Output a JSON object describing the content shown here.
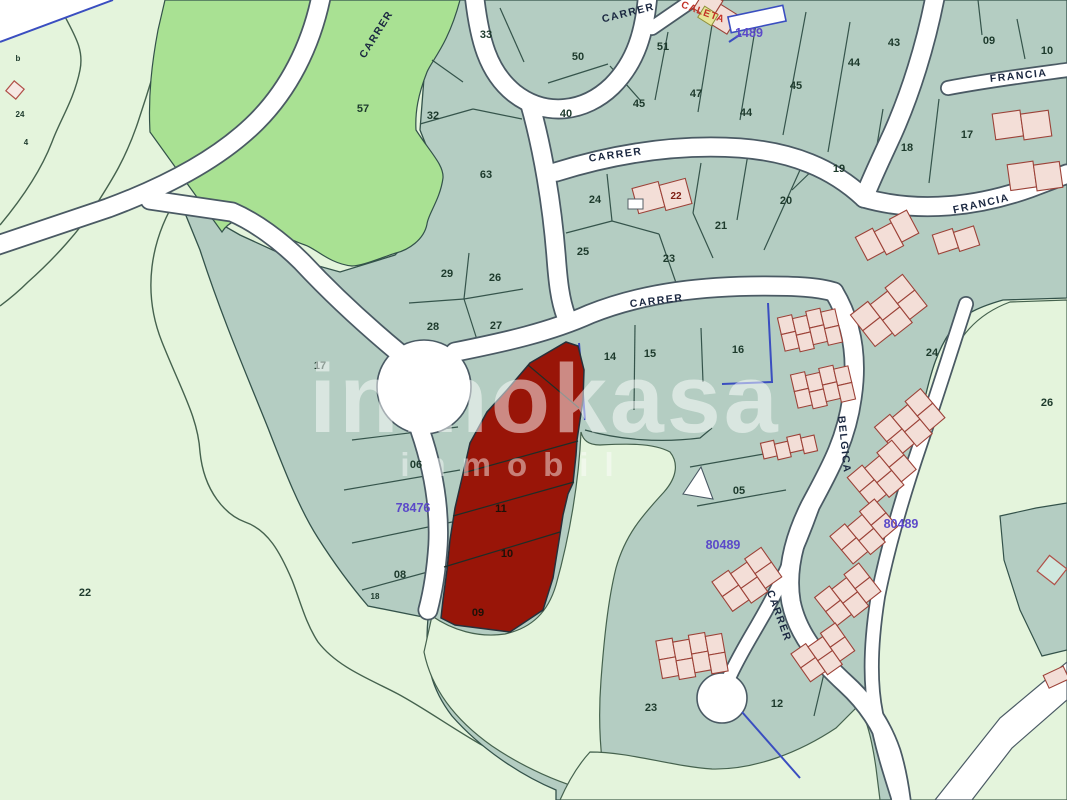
{
  "title": "Cadastral parcel map",
  "watermark": {
    "line1": "inmokasa",
    "line2": "inmobil"
  },
  "colors": {
    "pale": "#e4f4dc",
    "teal": "#b4cdc2",
    "bright": "#a9e193",
    "red_parcel": "#991508",
    "street": "#ffffff",
    "casing": "#4a5a64",
    "boundary": "#33524a",
    "purple": "#5b49c9",
    "street_text": "#1a2740",
    "parcel_text": "#1d3a2c",
    "building_fill": "#f3ded7",
    "building_stroke": "#9c4238",
    "caleta": "#c23227",
    "blue_line": "#3a4ec0"
  },
  "street_labels": [
    {
      "text": "CARRER",
      "x": 379,
      "y": 36,
      "rot": -58
    },
    {
      "text": "CARRER",
      "x": 629,
      "y": 16,
      "rot": -14
    },
    {
      "text": "CARRER",
      "x": 616,
      "y": 158,
      "rot": -8
    },
    {
      "text": "FRANCIA",
      "x": 1019,
      "y": 79,
      "rot": -6
    },
    {
      "text": "FRANCIA",
      "x": 982,
      "y": 207,
      "rot": -13
    },
    {
      "text": "CARRER",
      "x": 657,
      "y": 304,
      "rot": -7
    },
    {
      "text": "BELGICA",
      "x": 841,
      "y": 445,
      "rot": 84
    },
    {
      "text": "CARRER",
      "x": 776,
      "y": 617,
      "rot": 70
    }
  ],
  "special_labels": [
    {
      "text": "CALETA",
      "x": 702,
      "y": 15,
      "rot": 20
    }
  ],
  "building_labels": [
    {
      "text": "22",
      "x": 676,
      "y": 199
    }
  ],
  "ref_labels": [
    {
      "text": "1489",
      "x": 749,
      "y": 37
    },
    {
      "text": "78476",
      "x": 413,
      "y": 512
    },
    {
      "text": "80489",
      "x": 723,
      "y": 549
    },
    {
      "text": "80489",
      "x": 901,
      "y": 528
    }
  ],
  "parcel_labels": [
    {
      "text": "33",
      "x": 486,
      "y": 38
    },
    {
      "text": "50",
      "x": 578,
      "y": 60
    },
    {
      "text": "51",
      "x": 663,
      "y": 50
    },
    {
      "text": "57",
      "x": 363,
      "y": 112
    },
    {
      "text": "32",
      "x": 433,
      "y": 119
    },
    {
      "text": "63",
      "x": 486,
      "y": 178
    },
    {
      "text": "40",
      "x": 566,
      "y": 117
    },
    {
      "text": "45",
      "x": 639,
      "y": 107
    },
    {
      "text": "47",
      "x": 696,
      "y": 97
    },
    {
      "text": "44",
      "x": 746,
      "y": 116
    },
    {
      "text": "45",
      "x": 796,
      "y": 89
    },
    {
      "text": "44",
      "x": 854,
      "y": 66
    },
    {
      "text": "43",
      "x": 894,
      "y": 46
    },
    {
      "text": "09",
      "x": 989,
      "y": 44
    },
    {
      "text": "10",
      "x": 1047,
      "y": 54
    },
    {
      "text": "17",
      "x": 967,
      "y": 138
    },
    {
      "text": "18",
      "x": 907,
      "y": 151
    },
    {
      "text": "19",
      "x": 839,
      "y": 172
    },
    {
      "text": "20",
      "x": 786,
      "y": 204
    },
    {
      "text": "21",
      "x": 721,
      "y": 229
    },
    {
      "text": "24",
      "x": 595,
      "y": 203
    },
    {
      "text": "25",
      "x": 583,
      "y": 255
    },
    {
      "text": "23",
      "x": 669,
      "y": 262
    },
    {
      "text": "29",
      "x": 447,
      "y": 277
    },
    {
      "text": "26",
      "x": 495,
      "y": 281
    },
    {
      "text": "28",
      "x": 433,
      "y": 330
    },
    {
      "text": "27",
      "x": 496,
      "y": 329
    },
    {
      "text": "17",
      "x": 320,
      "y": 369
    },
    {
      "text": "14",
      "x": 610,
      "y": 360
    },
    {
      "text": "15",
      "x": 650,
      "y": 357
    },
    {
      "text": "16",
      "x": 738,
      "y": 353
    },
    {
      "text": "24",
      "x": 932,
      "y": 356
    },
    {
      "text": "26",
      "x": 1047,
      "y": 406
    },
    {
      "text": "06",
      "x": 416,
      "y": 468
    },
    {
      "text": "08",
      "x": 400,
      "y": 578
    },
    {
      "text": "18",
      "x": 375,
      "y": 599,
      "small": true
    },
    {
      "text": "05",
      "x": 739,
      "y": 494
    },
    {
      "text": "23",
      "x": 651,
      "y": 711
    },
    {
      "text": "12",
      "x": 777,
      "y": 707
    },
    {
      "text": "22",
      "x": 85,
      "y": 596
    },
    {
      "text": "24",
      "x": 20,
      "y": 117,
      "small": true
    },
    {
      "text": "b",
      "x": 18,
      "y": 61,
      "small": true
    },
    {
      "text": "4",
      "x": 26,
      "y": 145,
      "small": true
    },
    {
      "text": "11",
      "x": 501,
      "y": 512,
      "onred": true
    },
    {
      "text": "10",
      "x": 507,
      "y": 557,
      "onred": true
    },
    {
      "text": "09",
      "x": 478,
      "y": 616,
      "onred": true
    }
  ]
}
